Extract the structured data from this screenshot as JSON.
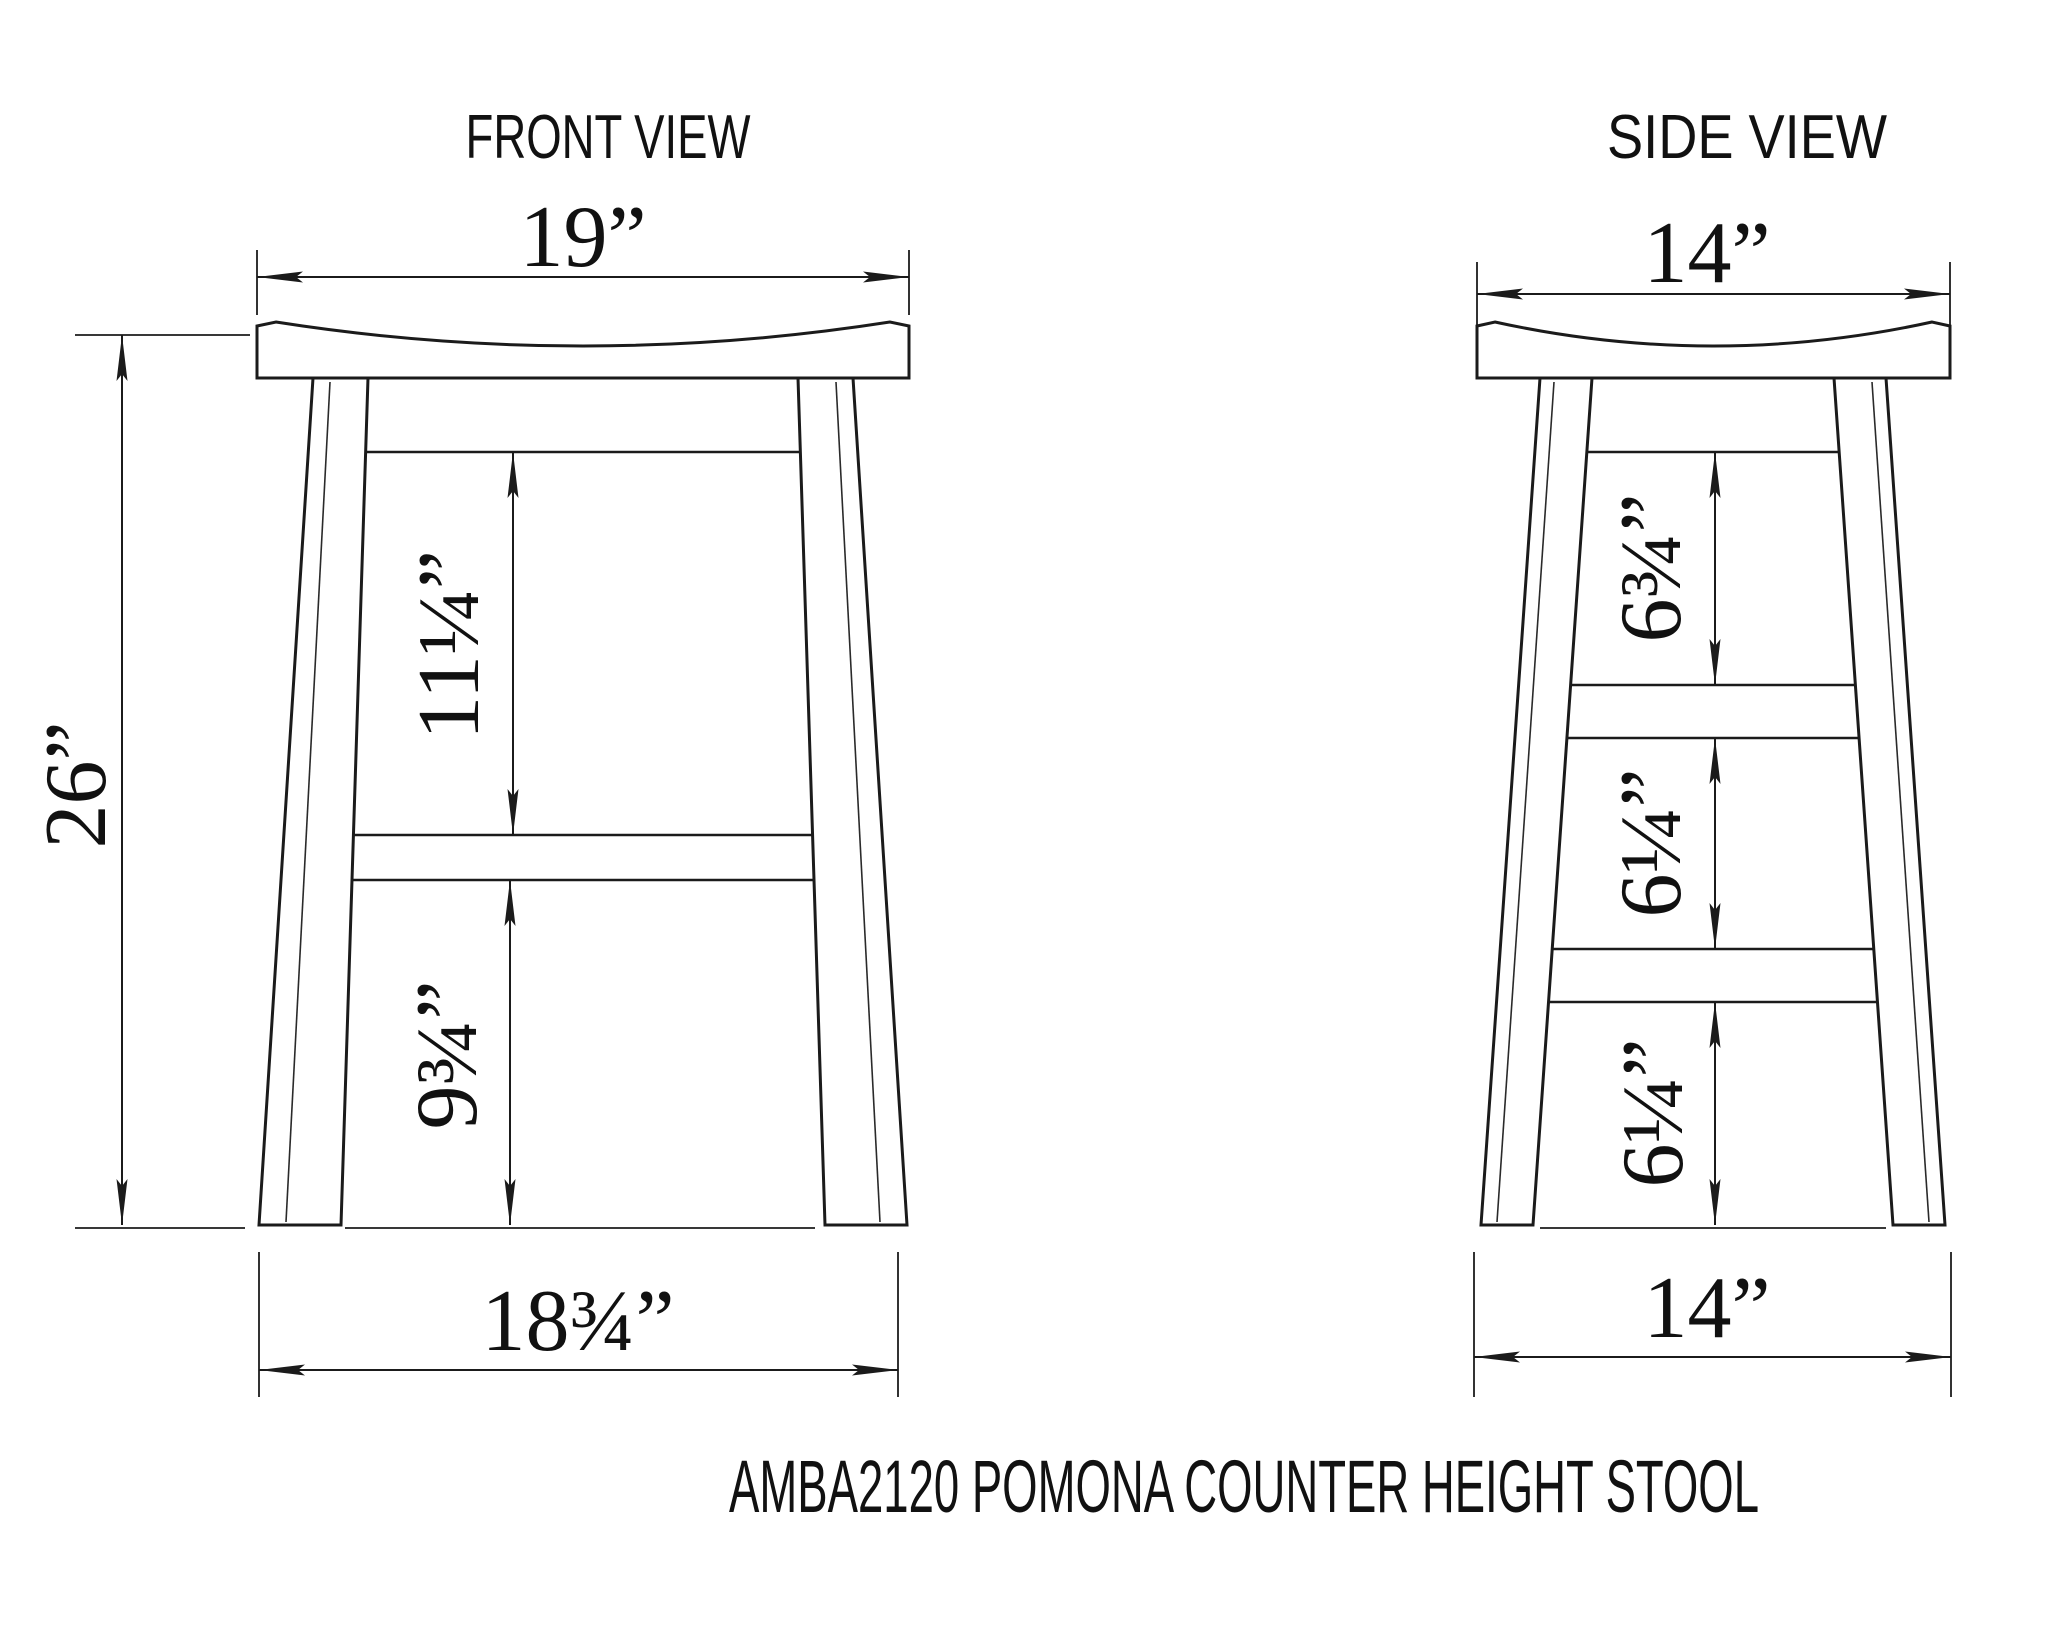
{
  "front_view": {
    "title": "FRONT VIEW",
    "dims": {
      "top_width": "19”",
      "height": "26”",
      "apron_to_stretcher": "11¼”",
      "stretcher_to_floor": "9¾”",
      "bottom_width": "18¾”"
    }
  },
  "side_view": {
    "title": "SIDE  VIEW",
    "dims": {
      "top_width": "14”",
      "upper_gap": "6¾”",
      "middle_gap": "6¼”",
      "lower_gap": "6¼”",
      "bottom_width": "14”"
    }
  },
  "caption": "AMBA2120 POMONA COUNTER HEIGHT STOOL",
  "colors": {
    "line": "#1b1b1b",
    "background": "#ffffff",
    "text": "#111111"
  }
}
